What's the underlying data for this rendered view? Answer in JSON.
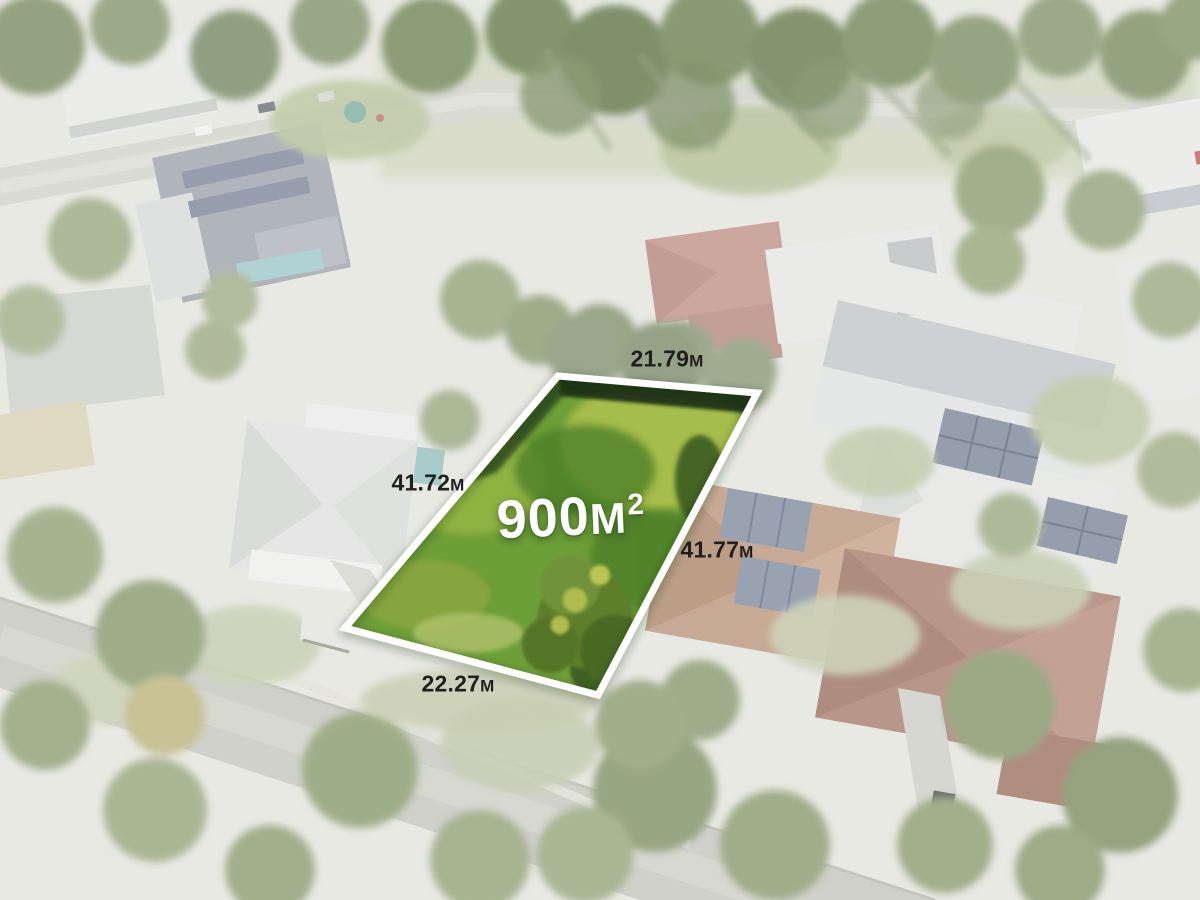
{
  "scene": {
    "alt": "Aerial drone photo of a suburban neighbourhood, surroundings washed out white, with a vacant grassy block highlighted in vivid green and outlined in white",
    "colors": {
      "lot_grass": "#6d9f38",
      "lot_border": "#ffffff",
      "dimension_text": "#1f1f1f",
      "area_text": "#ffffff"
    }
  },
  "lot": {
    "area": {
      "value": "900",
      "unit": "M",
      "exponent": "2"
    },
    "dimensions": {
      "top": {
        "value": "21.79",
        "unit": "M"
      },
      "left": {
        "value": "41.72",
        "unit": "M"
      },
      "right": {
        "value": "41.77",
        "unit": "M"
      },
      "bottom": {
        "value": "22.27",
        "unit": "M"
      }
    }
  }
}
